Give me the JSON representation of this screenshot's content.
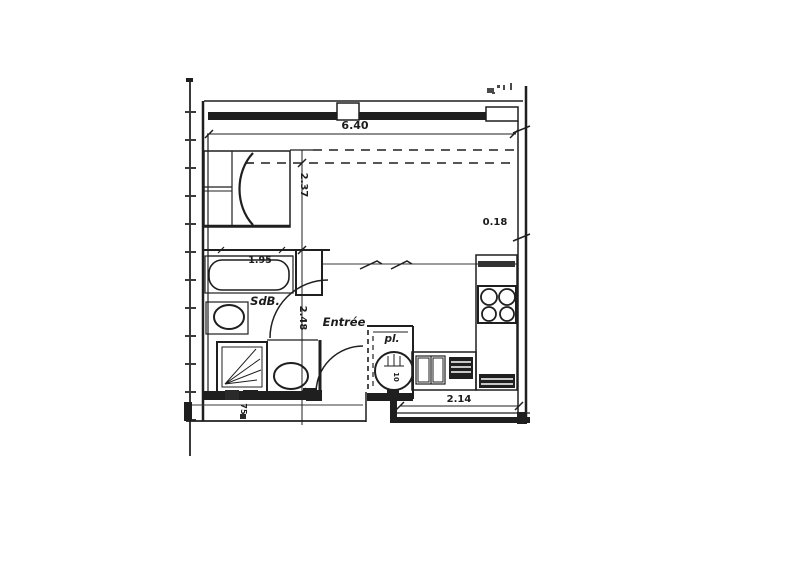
{
  "plan": {
    "labels": {
      "bathroom": "SdB.",
      "entry": "Entrée",
      "closet": "pl.",
      "water_heater": "10"
    },
    "dimensions": {
      "top_width": "6.40",
      "bed_area_depth": "2.37",
      "wall_offset": "0.18",
      "bathtub_length": "1.95",
      "entry_depth": "2.48",
      "kitchen_width": "2.14",
      "landing_width": "75"
    },
    "colors": {
      "ink": "#1f1f1f",
      "ink_light": "#555555",
      "paper": "#ffffff"
    }
  }
}
